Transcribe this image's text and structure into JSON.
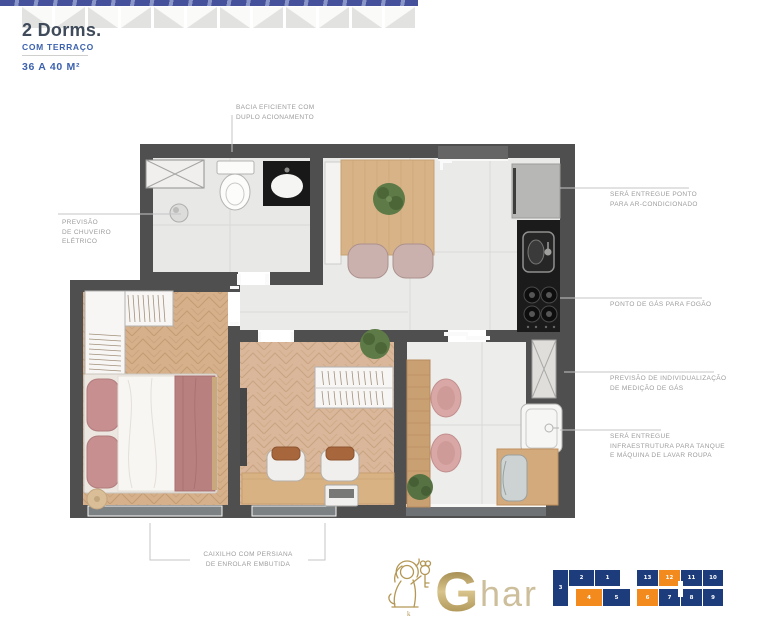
{
  "header": {
    "title": "2 Dorms.",
    "subtitle": "COM TERRAÇO",
    "area": "36 A 40 M²"
  },
  "annotations": {
    "bacia": {
      "lines": [
        "BACIA EFICIENTE COM",
        "DUPLO ACIONAMENTO"
      ]
    },
    "chuveiro": {
      "lines": [
        "PREVISÃO",
        "DE CHUVEIRO",
        "ELÉTRICO"
      ]
    },
    "ar": {
      "lines": [
        "SERÁ ENTREGUE PONTO",
        "PARA AR-CONDICIONADO"
      ]
    },
    "gas": {
      "lines": [
        "PONTO DE GÁS PARA FOGÃO"
      ]
    },
    "medicao": {
      "lines": [
        "PREVISÃO DE INDIVIDUALIZAÇÃO",
        "DE MEDIÇÃO DE GÁS"
      ]
    },
    "tanque": {
      "lines": [
        "SERÁ ENTREGUE",
        "INFRAESTRUTURA PARA TANQUE",
        "E MÁQUINA DE LAVAR ROUPA"
      ]
    },
    "caixilho": {
      "lines": [
        "CAIXILHO COM PERSIANA",
        "DE ENROLAR EMBUTIDA"
      ]
    }
  },
  "logo": {
    "brand_initial": "G",
    "brand_rest": "har",
    "mark": "lion-with-key",
    "mark_letter": "k"
  },
  "key_plan": {
    "colors": {
      "navy": "#1d3c7c",
      "orange": "#f28a1d",
      "corridor": "#ffffff"
    },
    "units": [
      "3",
      "2",
      "1",
      "4",
      "5",
      "13",
      "12",
      "11",
      "10",
      "6",
      "7",
      "8",
      "9"
    ],
    "highlighted_units": [
      "4",
      "12",
      "6"
    ]
  },
  "palette": {
    "wall": "#4f4f4f",
    "tile_floor": "#eaeae8",
    "wood_floor": "#d5b08a",
    "counter_black": "#1b1b1b",
    "bed_rose": "#c78f8f",
    "plant_green": "#5d7a47",
    "accent_blue": "#3c62ae",
    "title_color": "#3f4a5a",
    "note_color": "#9c9c9c",
    "gold": "#b49755"
  },
  "plan_icons": [
    "exhaust-shaft",
    "toilet",
    "washbasin-counter",
    "shower-head",
    "dining-table",
    "dining-chair",
    "plant",
    "refrigerator",
    "kitchen-sink",
    "cooktop",
    "wardrobe",
    "double-bed",
    "pouf",
    "desk",
    "laptop",
    "desk-chair",
    "sliding-door",
    "bar-counter",
    "terrace-chair",
    "laundry-tank",
    "washing-machine",
    "gas-shaft",
    "window"
  ]
}
